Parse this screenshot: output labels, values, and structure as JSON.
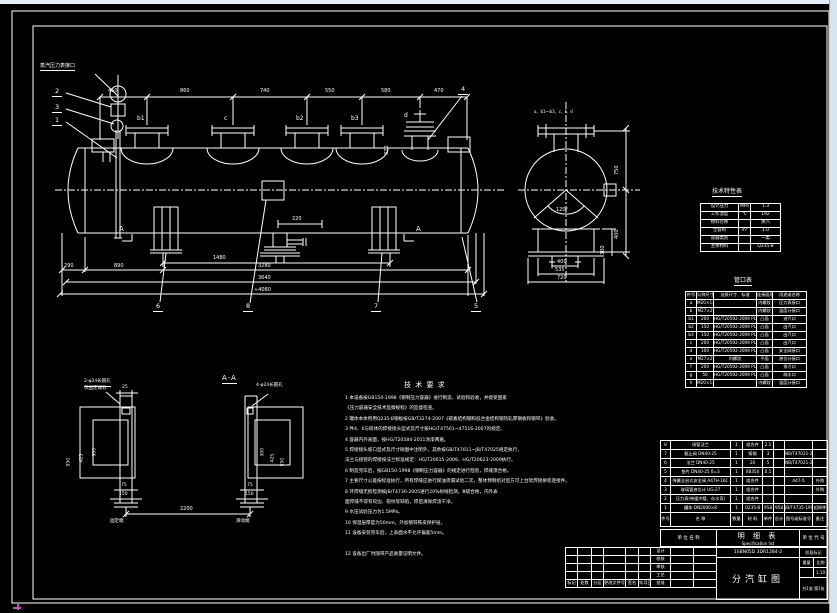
{
  "front_view": {
    "callout_label": "蒸汽压力表接口",
    "nozzle_labels": [
      "b1",
      "c",
      "b2",
      "b3",
      "d"
    ],
    "top_dims": [
      "450",
      "860",
      "740",
      "550",
      "580",
      "470"
    ],
    "balloons_left": [
      "2",
      "3",
      "1"
    ],
    "balloon_top_right": "4",
    "balloons_bottom": [
      "6",
      "8",
      "7",
      "5"
    ],
    "dim_370": "370",
    "dim_220": "220",
    "dim_1480": "1480",
    "dims_bottom": [
      "290",
      "890",
      "3280",
      "3640",
      "≈4080"
    ],
    "section_letter": "A"
  },
  "end_view": {
    "top_note": "a、b1～b3、c、f、d",
    "angle": "120°",
    "dims_right": [
      "750",
      "400",
      "300"
    ],
    "dims_bottom": [
      "400",
      "535",
      "720"
    ]
  },
  "spec_table": {
    "title": "技术特性表",
    "rows": [
      [
        "设计压力",
        "MPa",
        "1.3"
      ],
      [
        "工作温度",
        "℃",
        "192"
      ],
      [
        "物料名称",
        "",
        "蒸汽"
      ],
      [
        "全容积",
        "m³",
        "1.0"
      ],
      [
        "容器类别",
        "",
        "一类"
      ],
      [
        "主体材料",
        "",
        "Q235-B"
      ]
    ]
  },
  "nozzle_table": {
    "title": "管口表",
    "headers": [
      "符号",
      "公称尺寸",
      "连接尺寸、标准",
      "连接面形式",
      "用途或名称"
    ],
    "rows": [
      [
        "a",
        "M20×1.5",
        "",
        "内螺纹",
        "压力表接口"
      ],
      [
        "b",
        "M27×2",
        "",
        "内螺纹",
        "温度计接口"
      ],
      [
        "b1",
        "200",
        "HG/T20592-2009 PL200(B)-25 RF",
        "凸面",
        "进汽口"
      ],
      [
        "b2",
        "150",
        "HG/T20592-2009 PL150(B)-25 RF",
        "凸面",
        "出汽口"
      ],
      [
        "b3",
        "150",
        "HG/T20592-2009 PL150(B)-25 RF",
        "凸面",
        "出汽口"
      ],
      [
        "c",
        "200",
        "HG/T20592-2009 PL200(B)-25 RF",
        "凸面",
        "出汽口"
      ],
      [
        "d",
        "100",
        "HG/T20592-2009 PL100(B)-25 RF",
        "凸面",
        "安全阀接口"
      ],
      [
        "e",
        "M27×2",
        "内螺纹",
        "平面",
        "液位计接口"
      ],
      [
        "f",
        "200",
        "HG/T20592-2009 PL200(B)-25 RF",
        "凸面",
        "排污口"
      ],
      [
        "g",
        "50",
        "HG/T20592-2009 PL50(B)-25 RF",
        "凸面",
        "疏水口"
      ],
      [
        "h",
        "M20×1.5",
        "",
        "内螺纹",
        "温度计接口"
      ]
    ]
  },
  "bom": {
    "headers": [
      "件号",
      "名  称",
      "数量",
      "材 料",
      "单件",
      "总计",
      "图号或标准号",
      "备注"
    ],
    "rows": [
      [
        "8",
        "接管法兰",
        "1",
        "组合件",
        "2.1",
        "",
        "",
        ""
      ],
      [
        "7",
        "截止阀 DN40-25",
        "1",
        "铸钢",
        "3",
        "",
        "NB/T47021-2012",
        ""
      ],
      [
        "6",
        "法兰 DN40-25",
        "1",
        "20",
        "5",
        "",
        "NB/T47021-2012",
        ""
      ],
      [
        "5",
        "垫片 DN40-25 δ=3",
        "1",
        "XB350",
        "0.1",
        "",
        "",
        ""
      ],
      [
        "4",
        "弹簧全启式安全阀 A47H-16C",
        "1",
        "组合件",
        "",
        "",
        "A47-5",
        "外购"
      ],
      [
        "3",
        "玻璃管液位计 UG-27",
        "1",
        "组合件",
        "",
        "",
        "",
        "外购"
      ],
      [
        "2",
        "压力表(带缓冲管、存水弯)",
        "1",
        "组合件",
        "",
        "",
        "",
        ""
      ],
      [
        "1",
        "罐体 DN2000×8",
        "1",
        "Q235-B",
        "958",
        "958",
        "JB/T4735-1997",
        "组焊件"
      ]
    ],
    "footer": {
      "unit_name": "单 位 名 称",
      "list_title": "明  细  表",
      "list_title_en": "Specification list",
      "unit_code": "单 位 代 号"
    }
  },
  "titleblock": {
    "rev_labels": [
      [
        "标记",
        "处数",
        "分区",
        "更改文件号",
        "签名",
        "年月日"
      ]
    ],
    "sign_rows": [
      [
        "设计",
        "",
        ""
      ],
      [
        "校核",
        "",
        ""
      ],
      [
        "审核",
        "",
        ""
      ],
      [
        "工艺",
        "",
        ""
      ],
      [
        "批准",
        "",
        ""
      ]
    ],
    "drawing_no": "1SBN05D 3DR1284-2",
    "title": "分汽缸图",
    "stage_label": "阶段标记",
    "weight_label": "重量",
    "scale_label": "比例",
    "scale_value": "1:10",
    "sheet_info": "共1张 第1张"
  },
  "notes": {
    "title": "技 术 要 求",
    "lines": [
      "1  本设备按GB150-1998《钢制压力容器》进行制造、试验和验收，并接受国家",
      "   《压力容器安全技术监察规程》的监督检查。",
      "2  罐体本体所用Q235-B钢板按GB/T3274-2007《碳素结构钢和低合金结构钢热轧厚钢板和钢带》验收。",
      "3  件4、6与筒体的焊接接头型式及尺寸按HG/T47501~47516-2007的规定。",
      "4  容器内外表面，按HG/T20584-2011涂漆两遍。",
      "5  焊接接头坡口型式及尺寸除图中注明外，其余按GB/T47011~JB/T47025规定执行，",
      "   法兰与接管的焊接按法兰标准规定：HG/T20615-2009、HG/T20623-2009执行。",
      "6  制造完毕后，按GB150-1998《钢制压力容器》的规定进行检验，焊缝须合格。",
      "7  主要尺寸公差按标准执行，所有焊缝应进行煤油渗漏试验二次，整体预制组对后方可上台架焊接拼装连接件。",
      "8  环焊缝无损检测按JB/T4730-2005进行20%射线检测，Ⅲ级合格，内外表",
      "   面焊缝不得有咬边、裂纹等缺陷，焊后清除焊渣干净。",
      "9  水压试验压力为1.5MPa。",
      "10 保温层厚度为50mm，外加镀锌铁皮保护层。",
      "11 设备安装完毕后，上表面水平允许偏差5mm。",
      "",
      "12 设备出厂时随带产品质量证明文件。"
    ]
  },
  "section_aa": {
    "title": "A-A",
    "left_note_1": "2-φ24长圆孔",
    "left_note_2": "仅固定端有",
    "right_note": "4-φ24长圆孔",
    "dim_25": "25",
    "dims_left": [
      "550",
      "425",
      "300"
    ],
    "dims_right": [
      "300",
      "425",
      "550"
    ],
    "dim_75_l": "75",
    "dim_150_l": "150",
    "dim_75_r": "75",
    "dim_150_r": "150",
    "dim_span": "2200",
    "label_left": "固定端",
    "label_right": "滑动端"
  }
}
